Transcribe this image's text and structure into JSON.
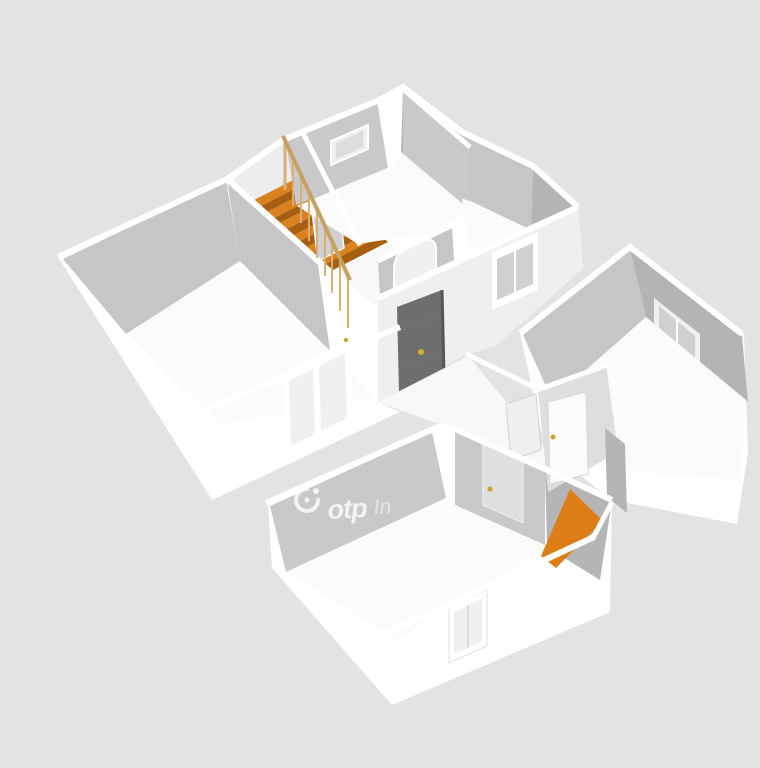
{
  "watermark": {
    "brand": "otp",
    "suffix": "In"
  },
  "palette": {
    "bg": "#e3e3e4",
    "wallWhite": "#ffffff",
    "wallLight": "#f0f0f2",
    "wallBand": "#efeff1",
    "faceLight": "#dedee0",
    "faceMid": "#c9c9cb",
    "faceMid2": "#c6c6c8",
    "faceDark": "#b4b4b6",
    "faceDark2": "#b5b5b7",
    "floor": "#fbfbfc",
    "floorDim": "#f8f8f9",
    "landing": "#ededef",
    "glass": "#dcdcde",
    "glassDim": "#d0d0d2",
    "doorDark": "#6e6e71",
    "doorLight": "#dfdfe1",
    "doorWhite": "#fbfbfd",
    "gold": "#c9a227",
    "knobGold": "#d9b02c",
    "stairTread": "#d9821f",
    "stairRiser": "#a85e10",
    "orangeFloor": "#dd7e17",
    "railWood": "#c7a163",
    "railPost": "#d4b277",
    "wmStrong": "rgba(255,255,255,0.78)",
    "wmSoft": "rgba(255,255,255,0.5)"
  },
  "counts": {
    "stair_steps": 6,
    "railing_balusters": 9
  }
}
